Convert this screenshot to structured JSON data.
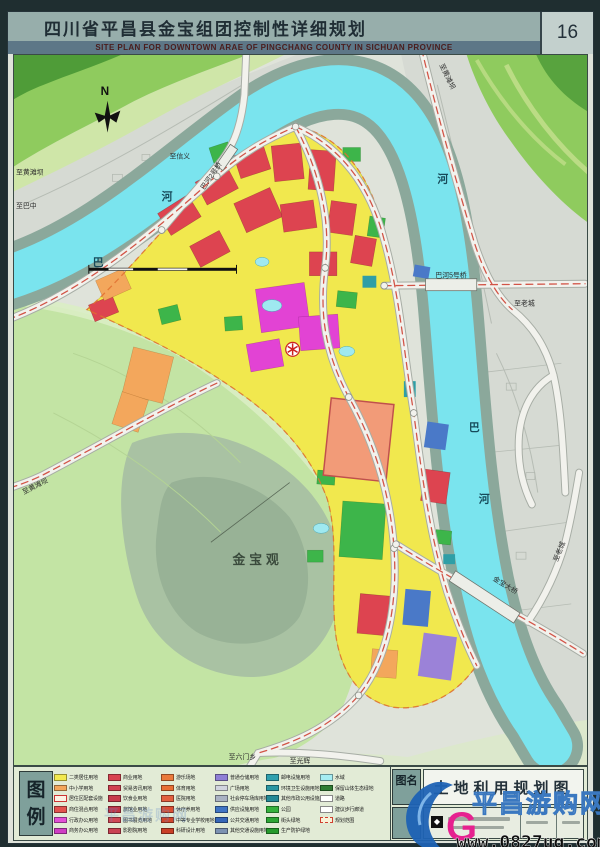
{
  "header": {
    "title": "四川省平昌县金宝组团控制性详细规划",
    "page_number": "16",
    "subtitle": "SITE PLAN FOR DOWNTOWN ARAE OF PINGCHANG COUNTY IN SICHUAN PROVINCE"
  },
  "map": {
    "labels": {
      "north": "N",
      "river_left_ba": "巴",
      "river_left_he": "河",
      "river_right_he": "河",
      "river_right_ba": "巴",
      "river_right_he2": "河",
      "to_huangtanba_left": "至黄滩坝",
      "to_bazhong": "至巴中",
      "to_xinyi": "至信义",
      "bridge_2": "巴河2号桥",
      "to_huangtanba_topright": "至黄滩坝",
      "to_laocheng_right": "至老城",
      "bridge_5": "巴河5号桥",
      "bridge_jinbao": "金宝大桥",
      "to_laocheng_se": "至老城",
      "to_huangtanba_sw": "至黄滩坝",
      "jinbaoguan": "金宝观",
      "to_liumenxiang": "至六门乡",
      "to_guanghui": "至光辉"
    }
  },
  "legend": {
    "panel_label": "图例",
    "columns": [
      {
        "items": [
          {
            "label": "二类居住用地",
            "color": "#f2e94f"
          },
          {
            "label": "中小学用地",
            "color": "#f3a75c"
          },
          {
            "label": "居住区配套设施",
            "color": "#fcf2e4",
            "variant": "outline-red"
          },
          {
            "label": "商住混合用地",
            "color": "#e2524e"
          },
          {
            "label": "行政办公用地",
            "color": "#e24fd6"
          },
          {
            "label": "商务办公用地",
            "color": "#cf3ec4"
          }
        ]
      },
      {
        "items": [
          {
            "label": "商业用地",
            "color": "#d84350"
          },
          {
            "label": "贸易咨讯用地",
            "color": "#d14050"
          },
          {
            "label": "饮食业用地",
            "color": "#c73a4c"
          },
          {
            "label": "旅馆业用地",
            "color": "#c23648"
          },
          {
            "label": "图书展览用地",
            "color": "#d04856"
          },
          {
            "label": "影剧院用地",
            "color": "#c94252"
          }
        ]
      },
      {
        "items": [
          {
            "label": "游乐场地",
            "color": "#ea7a3c"
          },
          {
            "label": "体育用地",
            "color": "#e86f35"
          },
          {
            "label": "医院用地",
            "color": "#e2603f"
          },
          {
            "label": "休疗养用地",
            "color": "#d94e32"
          },
          {
            "label": "中等专业学校用地",
            "color": "#d1462c"
          },
          {
            "label": "科研设计用地",
            "color": "#c93f27"
          }
        ]
      },
      {
        "items": [
          {
            "label": "普通仓储用地",
            "color": "#8f7fd6"
          },
          {
            "label": "广场用地",
            "color": "#d0d4de"
          },
          {
            "label": "社会停车场库用地",
            "color": "#a9b2c3"
          },
          {
            "label": "供应设施用地",
            "color": "#3f74c4"
          },
          {
            "label": "公共交通用地",
            "color": "#3566b8"
          },
          {
            "label": "其他交通设施用地",
            "color": "#7c92b2"
          }
        ]
      },
      {
        "items": [
          {
            "label": "邮电设施用地",
            "color": "#2fa0ae"
          },
          {
            "label": "环境卫生设施用地",
            "color": "#2a96a2"
          },
          {
            "label": "其他市政公用设施用地",
            "color": "#248a96"
          },
          {
            "label": "公园",
            "color": "#35b13c"
          },
          {
            "label": "街头绿地",
            "color": "#2da534"
          },
          {
            "label": "生产防护绿地",
            "color": "#26992c"
          }
        ]
      },
      {
        "items": [
          {
            "label": "水域",
            "color": "#a5edf2"
          },
          {
            "label": "保留山体生态绿地",
            "color": "#2f7d33"
          },
          {
            "label": "道路",
            "color": "#ffffff",
            "variant": "outline"
          },
          {
            "label": "建议步行廊道",
            "color": "#f3f3e6",
            "variant": "outline"
          },
          {
            "label": "规划范围",
            "color": "#f9f2d8",
            "variant": "dash"
          }
        ]
      }
    ]
  },
  "titleblock": {
    "name_label": "图名",
    "sheet_name": "土地利用规划图"
  },
  "watermark": {
    "site_name": "平昌游购网",
    "logo_g": "G",
    "url": "www.0827ug.com"
  },
  "palette": {
    "frame": "#1f2e30",
    "band": "#97aeab",
    "subtitle_band": "#5d7787",
    "page_box": "#c3d0cd",
    "paper": "#dfe3da",
    "oldtown": "#d6dad3",
    "terrain_light": "#cfe6a8",
    "terrain_mid": "#8fcb5e",
    "terrain_dark": "#4f9c38",
    "sw_green": "#c3e4a4",
    "hill_green": "#a9c2a3",
    "hill_core": "#98b296",
    "bank": "#8ba89b",
    "water": "#7ae4ee",
    "pond_cyan": "#9fe9f0",
    "res_yellow": "#f1e84e",
    "school_orange": "#f3a75c",
    "commercial_red": "#dd4450",
    "admin_magenta": "#e243d4",
    "park_green": "#3db54a",
    "util_teal": "#2f9ea6",
    "zone_blue": "#4a79c8",
    "zone_purple": "#9b82d8",
    "zone_salmon": "#f29b78",
    "road_fill": "#f2f2ed",
    "road_case": "#a7ada5",
    "main_road_dash": "#cf4436",
    "boundary_dash": "#e07030",
    "legend_bg": "#e2ebd6",
    "label_box": "#7fa09b"
  }
}
